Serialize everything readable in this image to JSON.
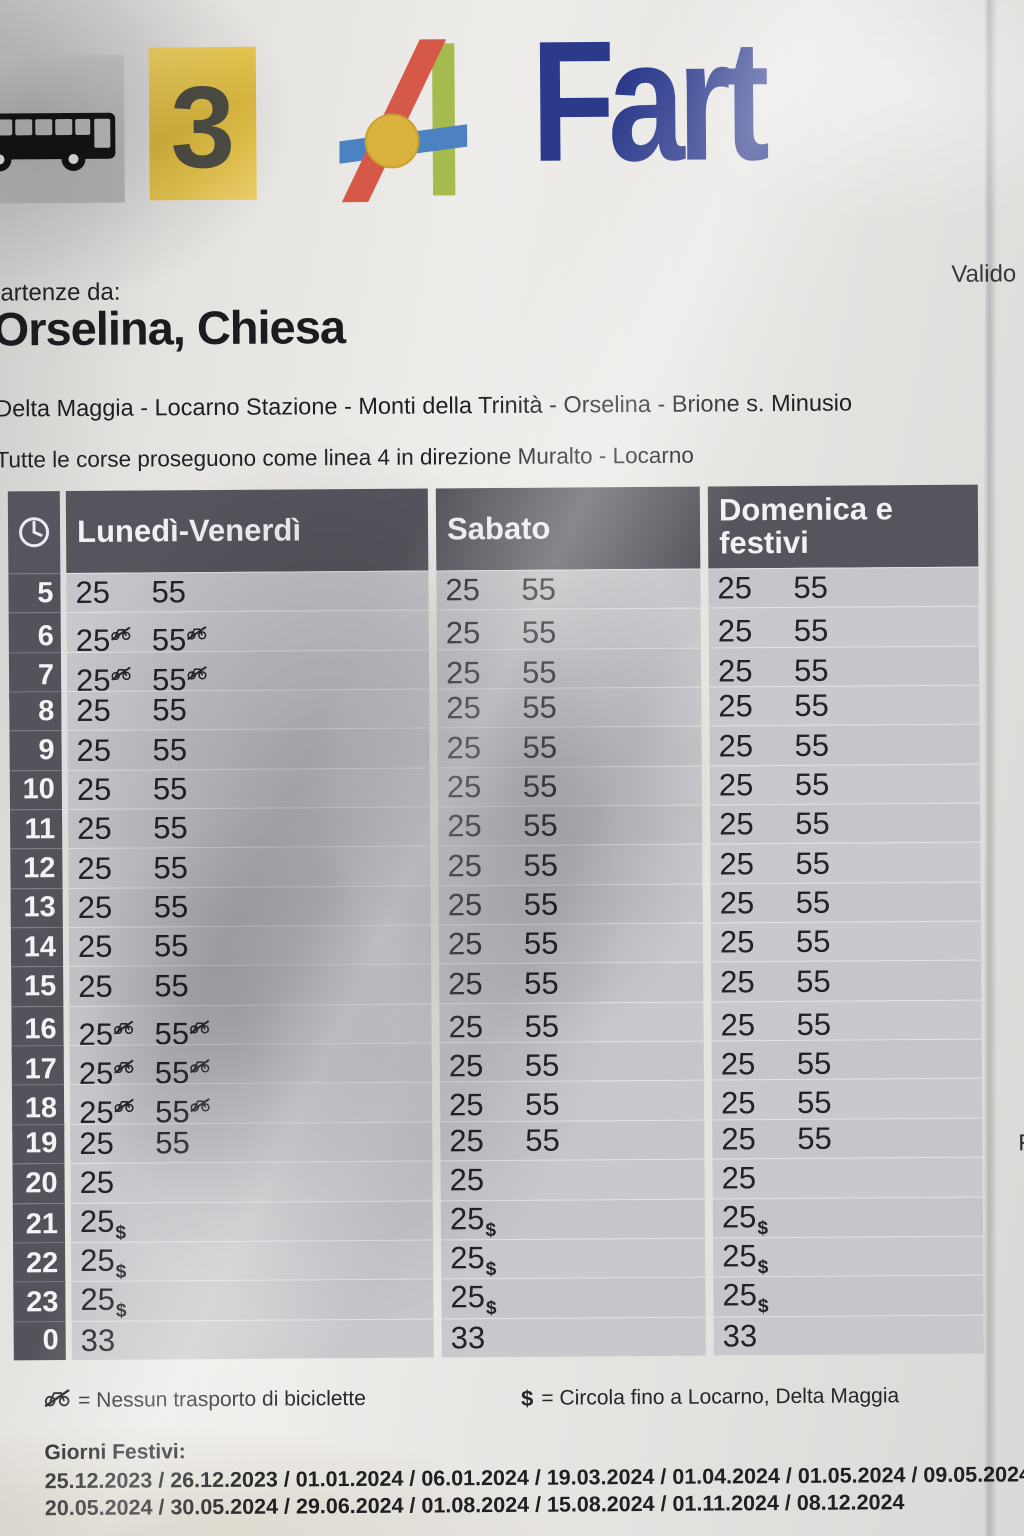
{
  "brand": {
    "line_number": "3",
    "operator_logo_text": "Fart",
    "valid_label": "Valido"
  },
  "intro": {
    "departures_label": "Partenze da:",
    "stop_name": "Orselina, Chiesa",
    "route_line": "Delta Maggia - Locarno Stazione - Monti della Trinità - Orselina - Brione s. Minusio",
    "service_note": "Tutte le corse proseguono come linea 4 in direzione Muralto - Locarno"
  },
  "timetable": {
    "column_headers": [
      "Lunedì-Venerdì",
      "Sabato",
      "Domenica e festivi"
    ],
    "symbols": {
      "*": "no-bicycle-transport",
      "$": "runs-only-to-locarno-delta-maggia"
    },
    "rows": [
      {
        "hour": "5",
        "cells": [
          [
            "25",
            "55"
          ],
          [
            "25",
            "55"
          ],
          [
            "25",
            "55"
          ]
        ]
      },
      {
        "hour": "6",
        "cells": [
          [
            "25*",
            "55*"
          ],
          [
            "25",
            "55"
          ],
          [
            "25",
            "55"
          ]
        ]
      },
      {
        "hour": "7",
        "cells": [
          [
            "25*",
            "55*"
          ],
          [
            "25",
            "55"
          ],
          [
            "25",
            "55"
          ]
        ]
      },
      {
        "hour": "8",
        "cells": [
          [
            "25",
            "55"
          ],
          [
            "25",
            "55"
          ],
          [
            "25",
            "55"
          ]
        ]
      },
      {
        "hour": "9",
        "cells": [
          [
            "25",
            "55"
          ],
          [
            "25",
            "55"
          ],
          [
            "25",
            "55"
          ]
        ]
      },
      {
        "hour": "10",
        "cells": [
          [
            "25",
            "55"
          ],
          [
            "25",
            "55"
          ],
          [
            "25",
            "55"
          ]
        ]
      },
      {
        "hour": "11",
        "cells": [
          [
            "25",
            "55"
          ],
          [
            "25",
            "55"
          ],
          [
            "25",
            "55"
          ]
        ]
      },
      {
        "hour": "12",
        "cells": [
          [
            "25",
            "55"
          ],
          [
            "25",
            "55"
          ],
          [
            "25",
            "55"
          ]
        ]
      },
      {
        "hour": "13",
        "cells": [
          [
            "25",
            "55"
          ],
          [
            "25",
            "55"
          ],
          [
            "25",
            "55"
          ]
        ]
      },
      {
        "hour": "14",
        "cells": [
          [
            "25",
            "55"
          ],
          [
            "25",
            "55"
          ],
          [
            "25",
            "55"
          ]
        ]
      },
      {
        "hour": "15",
        "cells": [
          [
            "25",
            "55"
          ],
          [
            "25",
            "55"
          ],
          [
            "25",
            "55"
          ]
        ]
      },
      {
        "hour": "16",
        "cells": [
          [
            "25*",
            "55*"
          ],
          [
            "25",
            "55"
          ],
          [
            "25",
            "55"
          ]
        ]
      },
      {
        "hour": "17",
        "cells": [
          [
            "25*",
            "55*"
          ],
          [
            "25",
            "55"
          ],
          [
            "25",
            "55"
          ]
        ]
      },
      {
        "hour": "18",
        "cells": [
          [
            "25*",
            "55*"
          ],
          [
            "25",
            "55"
          ],
          [
            "25",
            "55"
          ]
        ]
      },
      {
        "hour": "19",
        "cells": [
          [
            "25",
            "55"
          ],
          [
            "25",
            "55"
          ],
          [
            "25",
            "55"
          ]
        ]
      },
      {
        "hour": "20",
        "cells": [
          [
            "25"
          ],
          [
            "25"
          ],
          [
            "25"
          ]
        ]
      },
      {
        "hour": "21",
        "cells": [
          [
            "25$"
          ],
          [
            "25$"
          ],
          [
            "25$"
          ]
        ]
      },
      {
        "hour": "22",
        "cells": [
          [
            "25$"
          ],
          [
            "25$"
          ],
          [
            "25$"
          ]
        ]
      },
      {
        "hour": "23",
        "cells": [
          [
            "25$"
          ],
          [
            "25$"
          ],
          [
            "25$"
          ]
        ]
      },
      {
        "hour": "0",
        "cells": [
          [
            "33"
          ],
          [
            "33"
          ],
          [
            "33"
          ]
        ]
      }
    ]
  },
  "legend": {
    "bike_text": "= Nessun trasporto di biciclette",
    "dollar_symbol": "$",
    "dollar_text": "= Circola fino a Locarno, Delta Maggia"
  },
  "holidays": {
    "title": "Giorni Festivi:",
    "lines": [
      "25.12.2023 / 26.12.2023 / 01.01.2024 / 06.01.2024 / 19.03.2024 / 01.04.2024 / 01.05.2024 / 09.05.2024 /",
      "20.05.2024 / 30.05.2024 / 29.06.2024 / 01.08.2024 / 15.08.2024 / 01.11.2024 / 08.12.2024"
    ]
  },
  "edge_fragment": "F",
  "colors": {
    "header_band": "#56555d",
    "table_body": "#c6c5c9",
    "operator_blue": "#2c3a8c",
    "line_yellow": "#e3c04a"
  }
}
